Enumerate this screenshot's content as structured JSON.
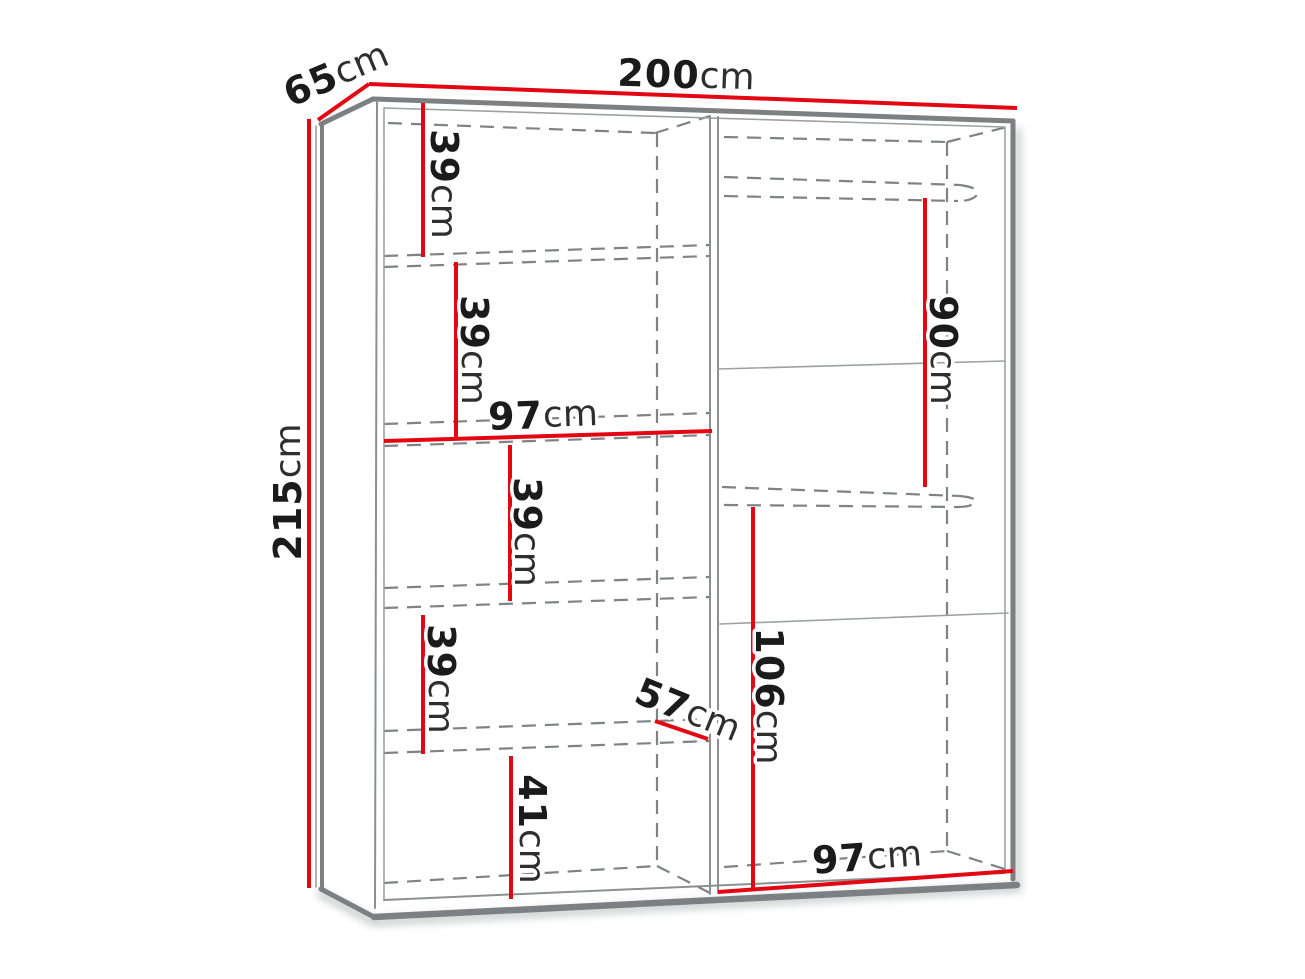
{
  "diagram": {
    "kind": "furniture dimension drawing",
    "subject": "wardrobe interior with shelf column and hanging section",
    "units": "cm",
    "colors": {
      "background": "#ffffff",
      "dimension_line": "#e30613",
      "cabinet_outline": "#7c8082",
      "hidden_edge": "#7f8385",
      "number_text": "#1b1b1b",
      "unit_text": "#2e2e2e"
    }
  },
  "labels": [
    {
      "id": "overall-depth",
      "value": "65",
      "unit": "cm"
    },
    {
      "id": "overall-width",
      "value": "200",
      "unit": "cm"
    },
    {
      "id": "overall-height",
      "value": "215",
      "unit": "cm"
    },
    {
      "id": "shelf-gap-1",
      "value": "39",
      "unit": "cm"
    },
    {
      "id": "shelf-gap-2",
      "value": "39",
      "unit": "cm"
    },
    {
      "id": "left-section-width",
      "value": "97",
      "unit": "cm"
    },
    {
      "id": "shelf-gap-3",
      "value": "39",
      "unit": "cm"
    },
    {
      "id": "shelf-gap-4",
      "value": "39",
      "unit": "cm"
    },
    {
      "id": "shelf-gap-5",
      "value": "41",
      "unit": "cm"
    },
    {
      "id": "interior-depth",
      "value": "57",
      "unit": "cm"
    },
    {
      "id": "hanging-upper-height",
      "value": "90",
      "unit": "cm"
    },
    {
      "id": "hanging-lower-height",
      "value": "106",
      "unit": "cm"
    },
    {
      "id": "right-section-width",
      "value": "97",
      "unit": "cm"
    }
  ]
}
